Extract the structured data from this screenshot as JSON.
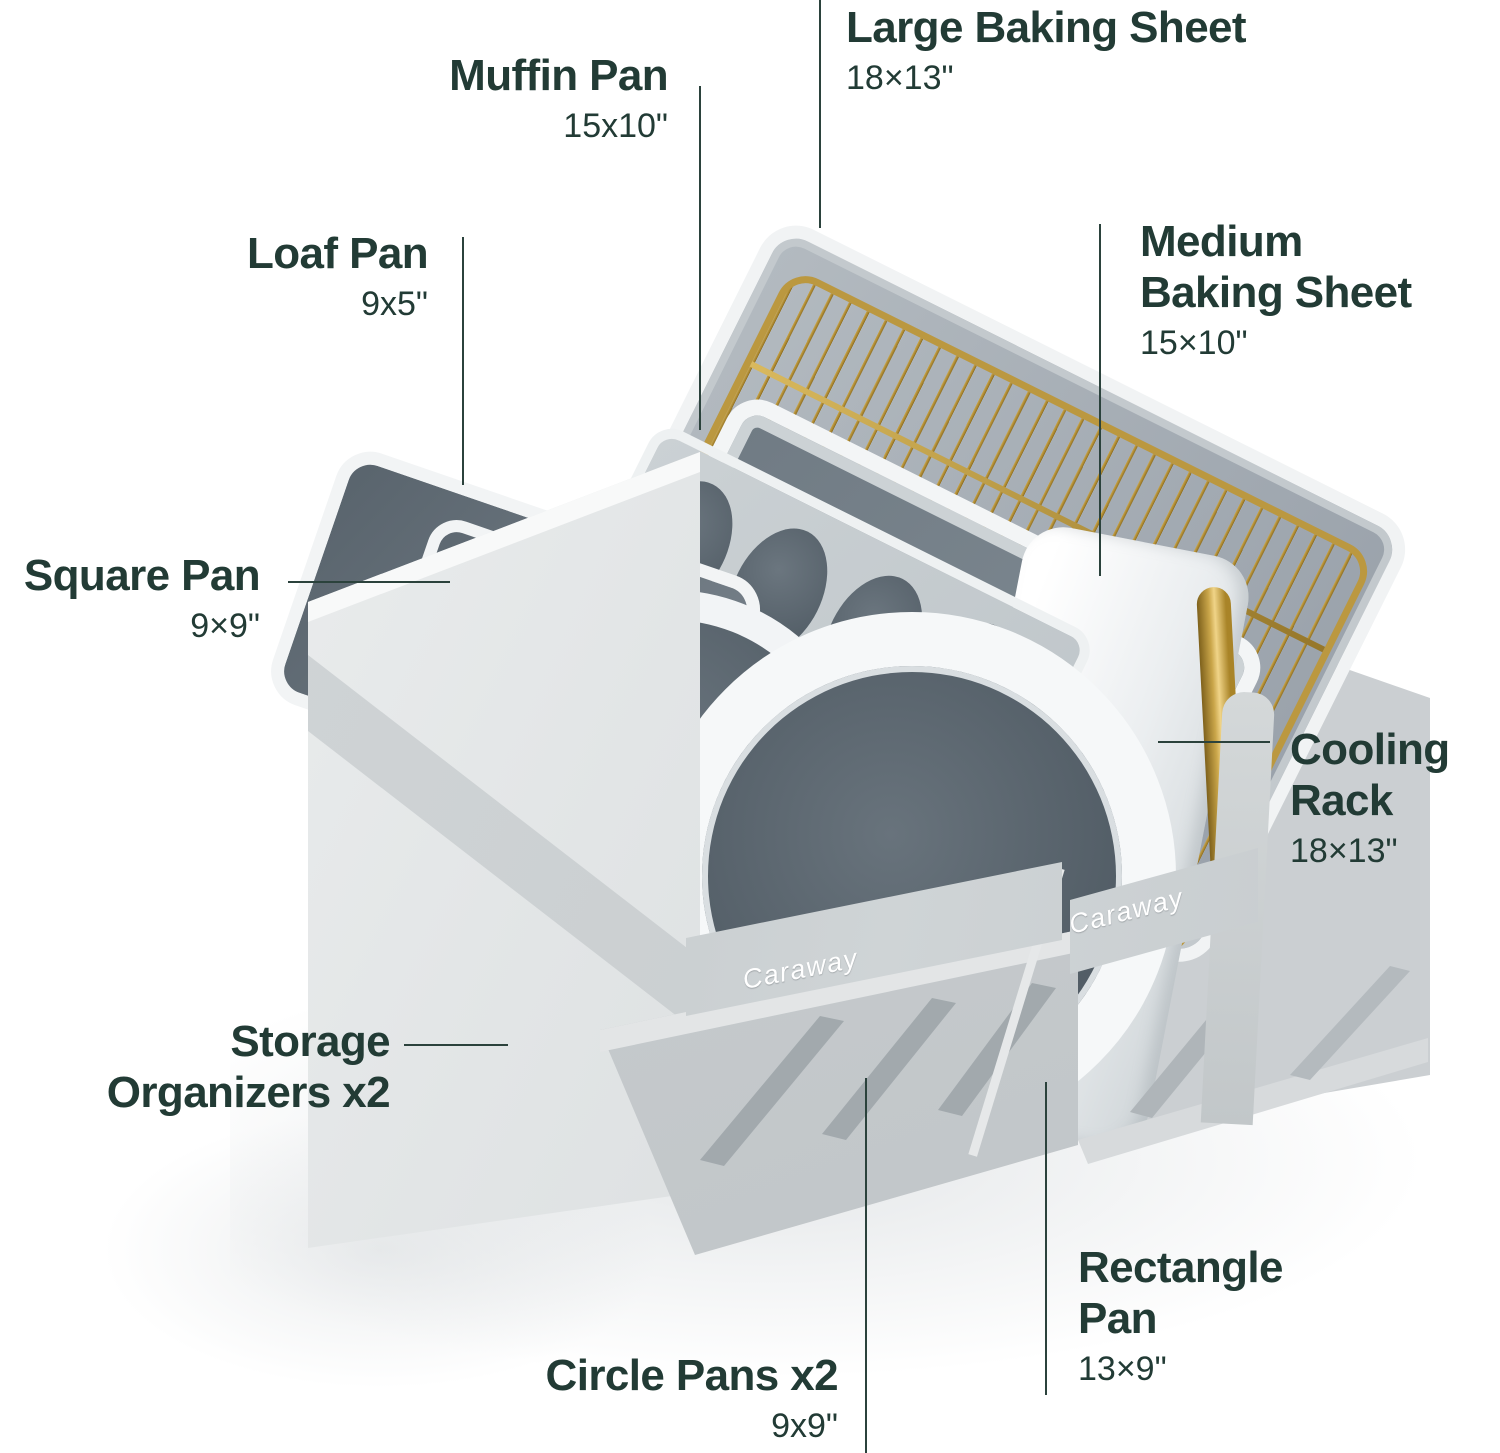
{
  "brand": {
    "logo_text": "Caraway"
  },
  "labels": {
    "large_baking_sheet": {
      "title": "Large Baking Sheet",
      "size": "18×13\""
    },
    "muffin_pan": {
      "title": "Muffin Pan",
      "size": "15x10\""
    },
    "loaf_pan": {
      "title": "Loaf Pan",
      "size": "9x5\""
    },
    "square_pan": {
      "title": "Square Pan",
      "size": "9×9\""
    },
    "medium_baking_sheet": {
      "title_line1": "Medium",
      "title_line2": "Baking Sheet",
      "size": "15×10\""
    },
    "cooling_rack": {
      "title_line1": "Cooling",
      "title_line2": "Rack",
      "size": "18×13\""
    },
    "storage_organizers": {
      "title_line1": "Storage",
      "title_line2": "Organizers x2"
    },
    "circle_pans": {
      "title": "Circle Pans x2",
      "size": "9x9\""
    },
    "rectangle_pan": {
      "title_line1": "Rectangle",
      "title_line2": "Pan",
      "size": "13×9\""
    }
  },
  "colors": {
    "label_text": "#223B35",
    "leader_line": "#2B423C",
    "fabric_light": "#E4E7E8",
    "fabric_mid": "#CDD1D3",
    "fabric_dark": "#AEB4B8",
    "pan_white": "#F4F6F7",
    "pan_interior": "#5F6A73",
    "sheet_gray": "#A4ABB3",
    "gold": "#BF9C42",
    "background": "#FFFFFF"
  }
}
